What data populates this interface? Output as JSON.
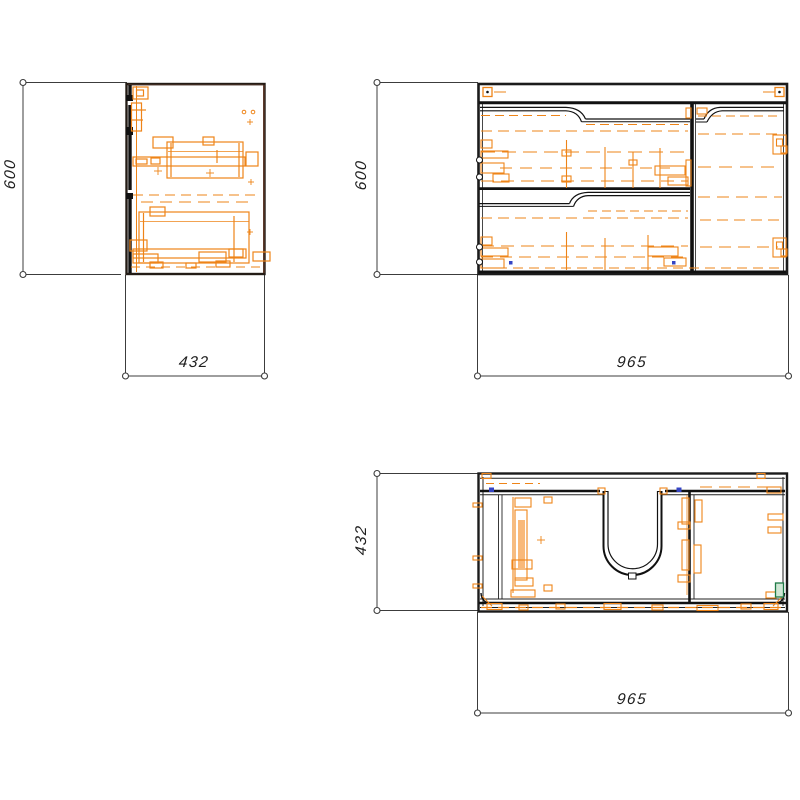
{
  "drawing": {
    "kind": "furniture-three-view-technical-drawing",
    "views": {
      "side": {
        "name": "side view",
        "width": "432",
        "height": "600"
      },
      "front": {
        "name": "front view",
        "width": "965",
        "height": "600"
      },
      "top": {
        "name": "top view",
        "width": "965",
        "depth": "432"
      }
    }
  },
  "dims": {
    "side_height": "600",
    "side_depth": "432",
    "front_height": "600",
    "front_width": "965",
    "top_depth": "432",
    "top_width": "965"
  },
  "colors": {
    "line": "#1b1b1b",
    "hardware_orange": "#ee8418",
    "dimension": "#3c3c3c",
    "edge_brown": "#5d3a2b",
    "accent_green": "#1e7a46",
    "accent_blue": "#3544c4",
    "background": "#ffffff"
  }
}
